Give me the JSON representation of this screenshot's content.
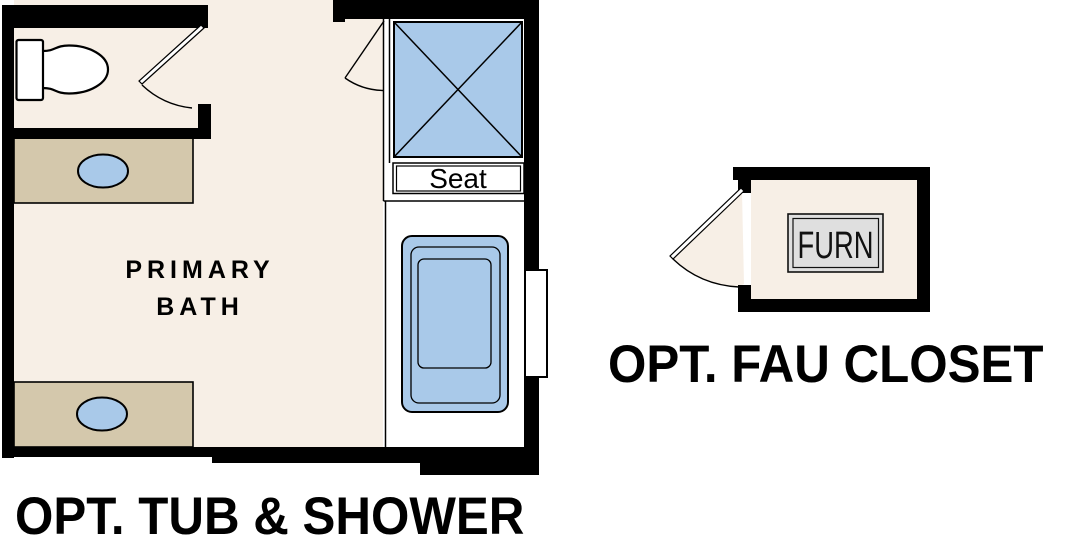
{
  "bath": {
    "room_label_lines": [
      "PRIMARY",
      "BATH"
    ],
    "seat_label": "Seat",
    "caption": "OPT. TUB & SHOWER"
  },
  "closet": {
    "furnace_label": "FURN",
    "caption": "OPT. FAU CLOSET"
  },
  "colors": {
    "background": "#ffffff",
    "floor": "#f7efe6",
    "counter": "#d4c8ac",
    "fixture": "#a9c9e9",
    "wall": "#000000",
    "furnace": "#dfdfdf",
    "outline": "#000000"
  }
}
